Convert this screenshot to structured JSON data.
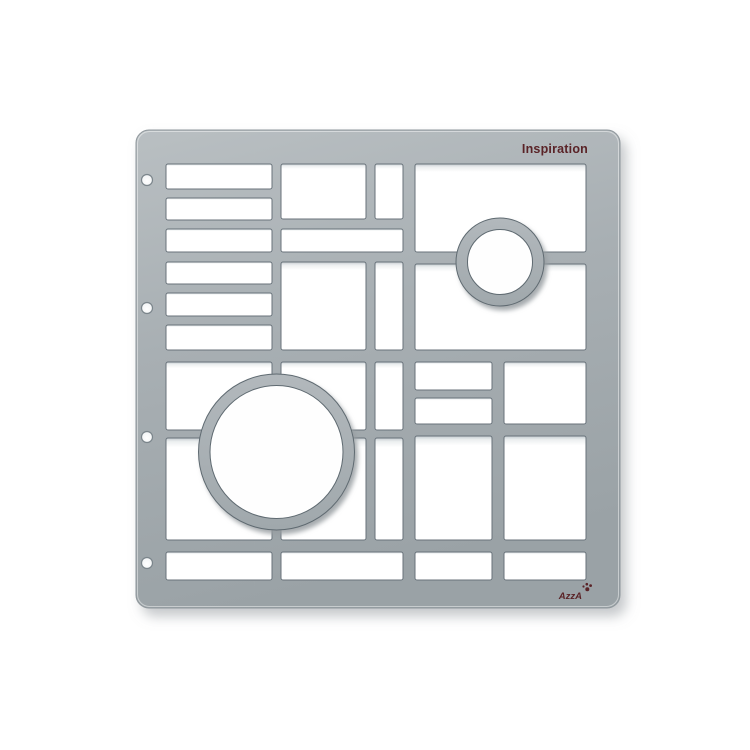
{
  "scene": {
    "description": "Product photo of a light-gray plastic scrapbooking stencil template lying on a white background. The plate has Mondrian-style rectangular cutout windows, one large circle ring, one small circle ring, and four binder holes along the left edge.",
    "background_color": "#ffffff"
  },
  "labels": {
    "title": "Inspiration",
    "brand": "AzzA"
  },
  "stencil": {
    "binder_hole_count": 4,
    "rectangular_windows": 25,
    "circle_rings": 2
  },
  "colors": {
    "plate_gray": "#a8afb3",
    "plate_highlight": "#b9bfc2",
    "plate_dark_edge": "#99a1a5",
    "cut_edge_outline": "#68727a",
    "label_maroon": "#5a2327",
    "cutout_white": "#ffffff"
  }
}
